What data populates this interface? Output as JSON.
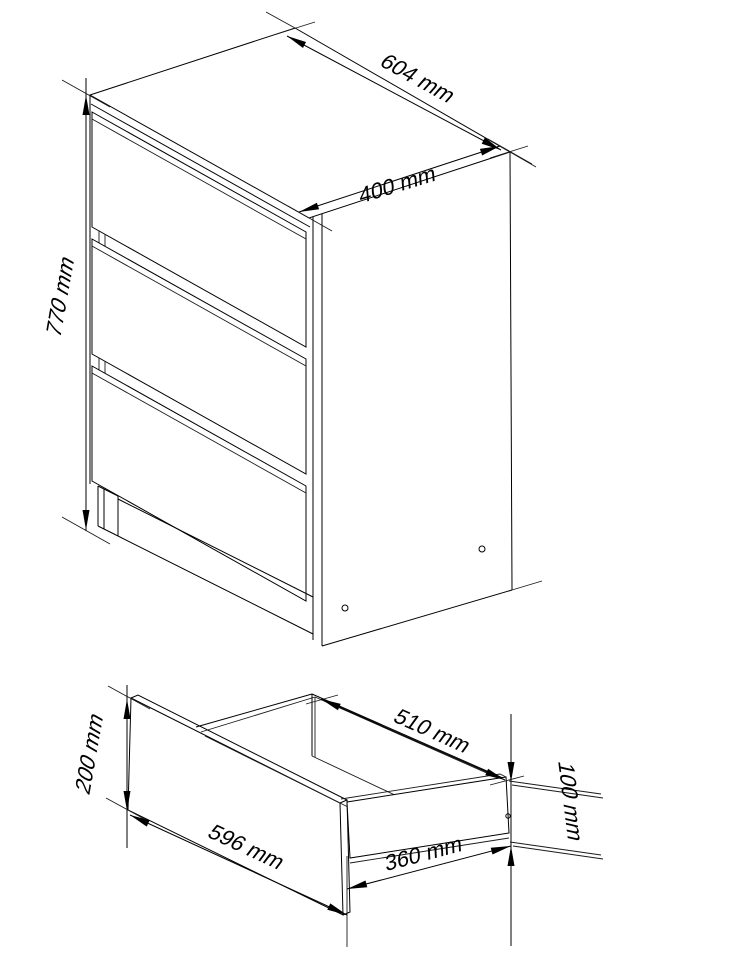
{
  "page": {
    "background_color": "#ffffff",
    "line_color": "#000000"
  },
  "views": {
    "cabinet": {
      "description": "three-drawer-chest-isometric-view",
      "dimensions": {
        "width": {
          "label": "604 mm",
          "value": 604,
          "unit": "mm"
        },
        "depth": {
          "label": "400 mm",
          "value": 400,
          "unit": "mm"
        },
        "height": {
          "label": "770 mm",
          "value": 770,
          "unit": "mm"
        }
      }
    },
    "drawer": {
      "description": "open-drawer-box-isometric-view",
      "dimensions": {
        "front_height": {
          "label": "200 mm",
          "value": 200,
          "unit": "mm"
        },
        "front_width": {
          "label": "596 mm",
          "value": 596,
          "unit": "mm"
        },
        "back_width": {
          "label": "510 mm",
          "value": 510,
          "unit": "mm"
        },
        "side_depth": {
          "label": "360 mm",
          "value": 360,
          "unit": "mm"
        },
        "side_height": {
          "label": "100 mm",
          "value": 100,
          "unit": "mm"
        }
      }
    }
  }
}
